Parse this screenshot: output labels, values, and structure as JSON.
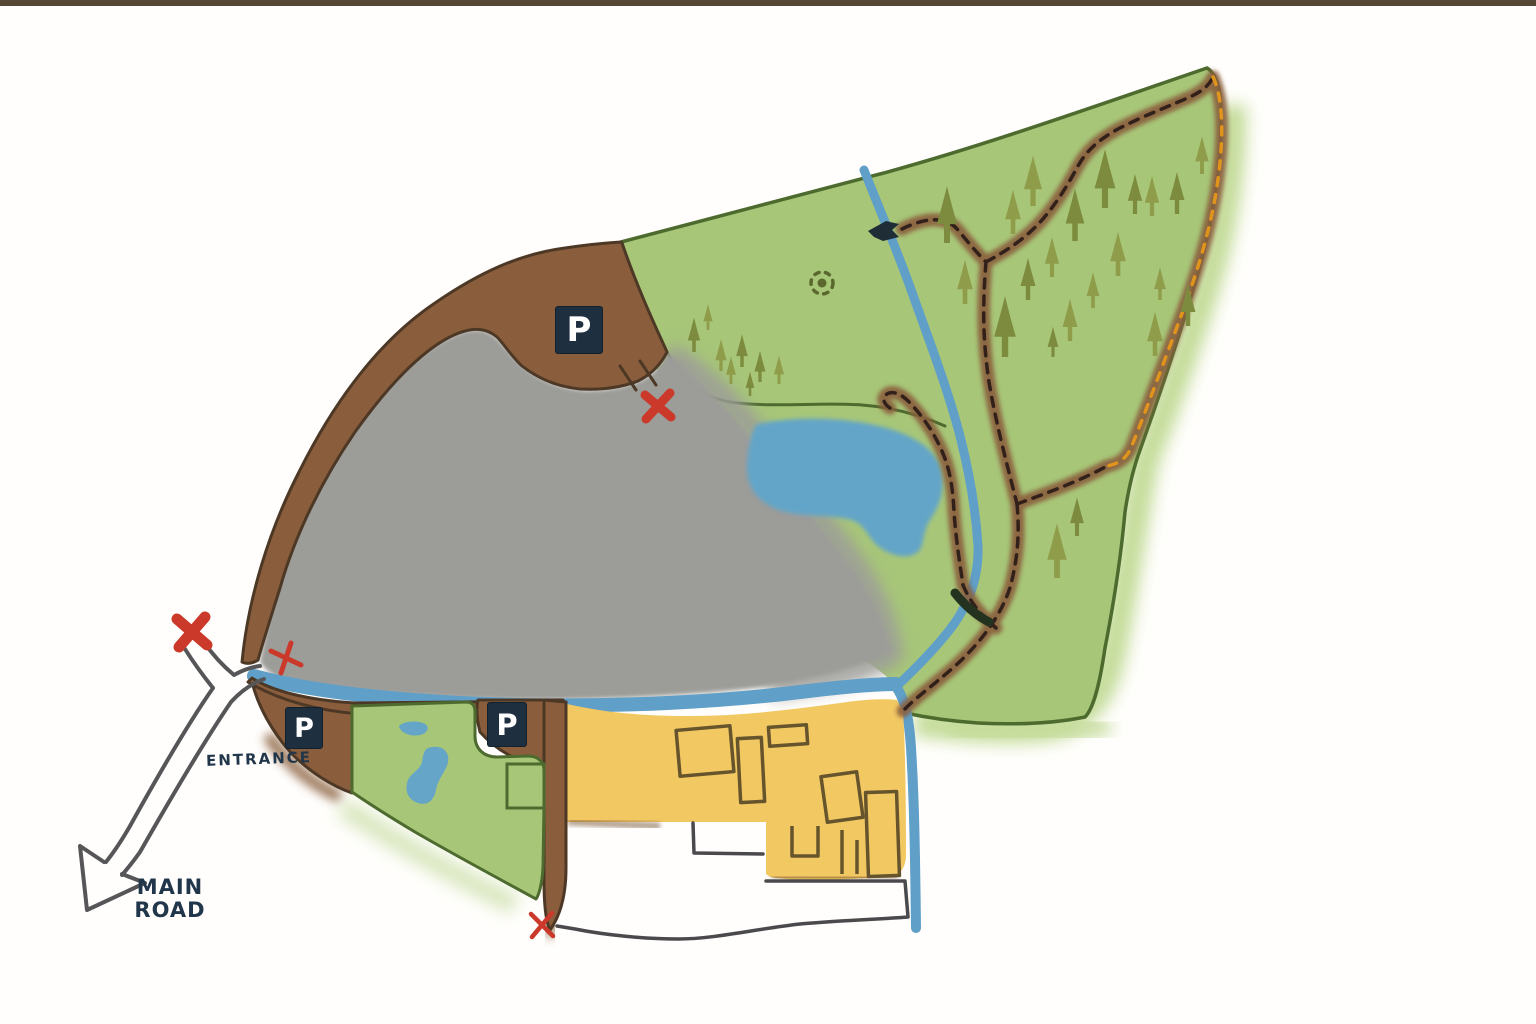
{
  "page": {
    "background": "#fffefc",
    "top_bar_color": "#564835",
    "description": "Hand-drawn nature reserve map with entrance road, parking areas, trails, streams, pond, woodland and farmyard"
  },
  "labels": {
    "entrance": "ENTRANCE",
    "main_road_line1": "MAIN",
    "main_road_line2": "ROAD",
    "parking": "P"
  },
  "legend": {
    "colors": {
      "field_green": "#a7c678",
      "field_outline_green": "#4d6b2e",
      "tree_olive_light": "#8f9d4b",
      "tree_olive_dark": "#7c8b3e",
      "heath_gray": "#9c9c99",
      "path_brown": "#8a5e3c",
      "path_outline_brown": "#4d3826",
      "water_blue": "#5f9fc8",
      "farmyard_yellow": "#f2c863",
      "building_outline": "#66552c",
      "sign_navy": "#1e2f40",
      "marker_red": "#cb392b",
      "road_gray": "#565659",
      "trail_dash_dark": "#32211a",
      "trail_dash_orange": "#e0941c",
      "label_navy": "#21364a"
    }
  },
  "icons": {
    "parking": "parking-sign",
    "bird": "bird-hide-icon",
    "bridge": "bridge-icon",
    "tree": "pine-tree-icon",
    "cross": "red-cross-marker",
    "landmark": "dotted-circle-landmark",
    "road_arrow": "main-road-arrow"
  },
  "markers": {
    "parking_sign_count": 3,
    "red_cross_count": 4
  }
}
